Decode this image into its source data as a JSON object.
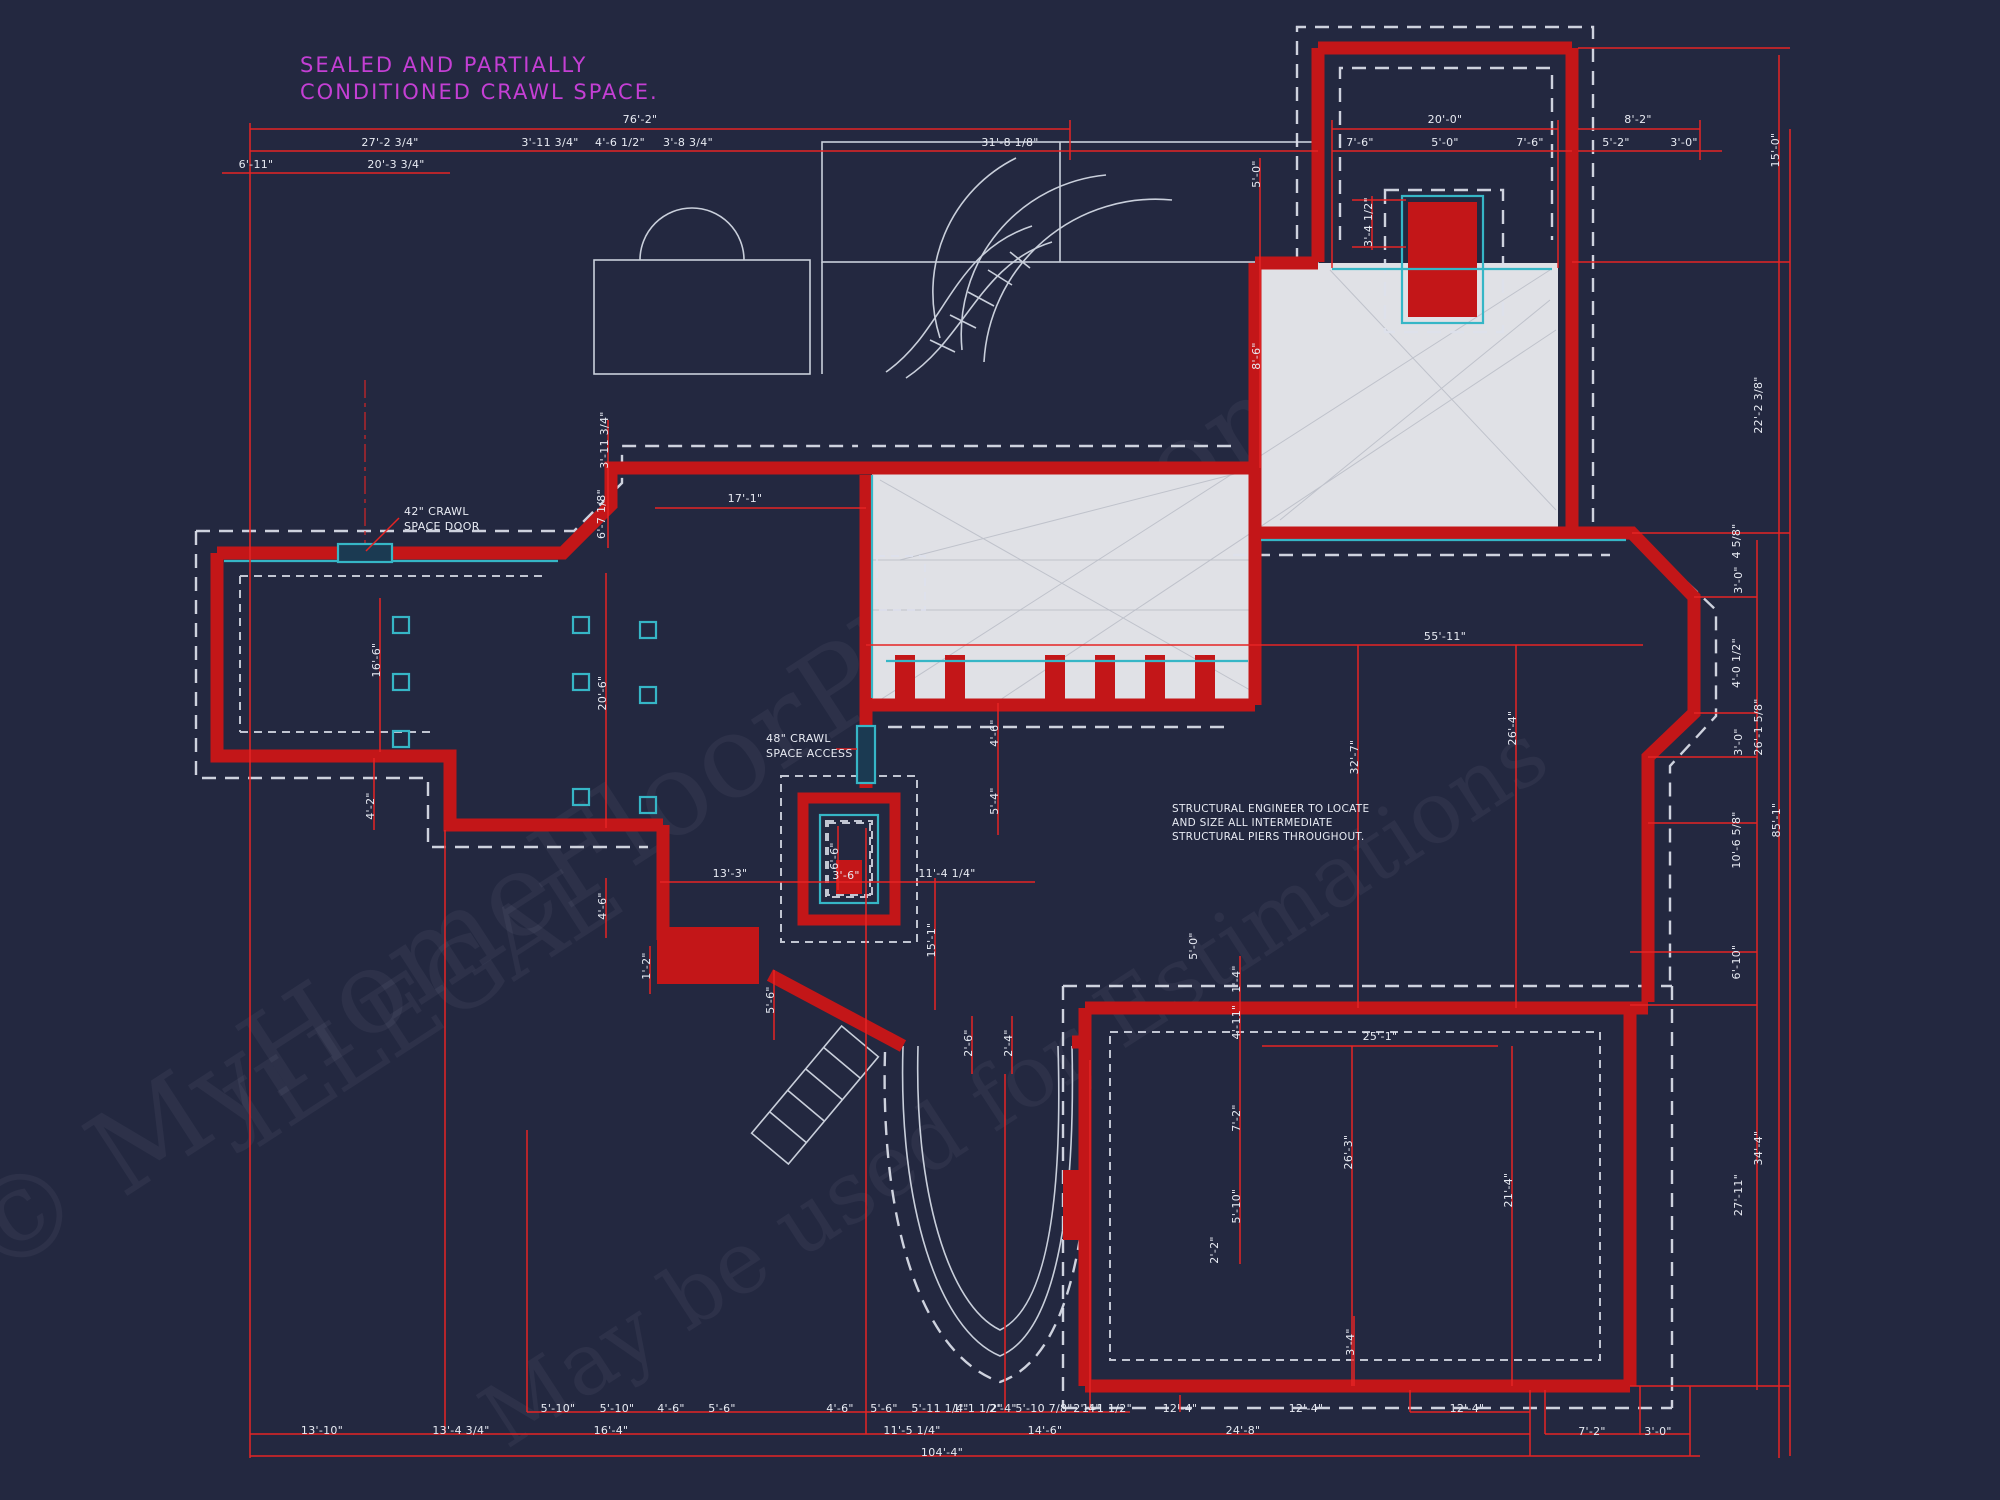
{
  "palette": {
    "background": "#232840",
    "wall_red": "#c31618",
    "dimension_red": "#e62424",
    "footing_white": "#dde1ec",
    "teal_accent": "#36b6c6",
    "slab_gray": "#e0e1e6",
    "note_magenta": "#c43fd4",
    "text_white": "#e8ebf3"
  },
  "annotations": [
    {
      "name": "crawl-space-note",
      "x": 300,
      "y": 72,
      "lh": 27,
      "size": 21,
      "spacing": "2px",
      "color": "#c43fd4",
      "lines": [
        "SEALED AND PARTIALLY",
        "CONDITIONED CRAWL SPACE."
      ]
    },
    {
      "name": "crawl-door-label",
      "x": 404,
      "y": 515,
      "lh": 15,
      "size": 11,
      "spacing": "0.4px",
      "color": "#e8ebf3",
      "lines": [
        "42\" CRAWL",
        "SPACE DOOR"
      ]
    },
    {
      "name": "crawl-access-label",
      "x": 766,
      "y": 742,
      "lh": 15,
      "size": 11,
      "spacing": "0.4px",
      "color": "#e8ebf3",
      "lines": [
        "48\" CRAWL",
        "SPACE ACCESS"
      ]
    },
    {
      "name": "engineer-note",
      "x": 1172,
      "y": 812,
      "lh": 14,
      "size": 10.5,
      "spacing": "0.3px",
      "color": "#e8ebf3",
      "lines": [
        "STRUCTURAL ENGINEER TO LOCATE",
        "AND SIZE ALL INTERMEDIATE",
        "STRUCTURAL PIERS THROUGHOUT."
      ]
    }
  ],
  "watermarks": [
    {
      "text": "© MyHomeFloorPlans.com",
      "x": 660,
      "y": 850,
      "size": 115,
      "rot": -33
    },
    {
      "text": "ILLEGAL",
      "x": 440,
      "y": 1030,
      "size": 95,
      "rot": -33
    },
    {
      "text": "May be used for Estimations",
      "x": 1030,
      "y": 1110,
      "size": 86,
      "rot": -33
    }
  ],
  "dimensions": [
    [
      "76'-2\"",
      640,
      123,
      "h"
    ],
    [
      "20'-0\"",
      1445,
      123,
      "h"
    ],
    [
      "8'-2\"",
      1638,
      123,
      "h"
    ],
    [
      "27'-2 3/4\"",
      390,
      146,
      "h"
    ],
    [
      "3'-11 3/4\"",
      550,
      146,
      "h"
    ],
    [
      "4'-6 1/2\"",
      620,
      146,
      "h"
    ],
    [
      "3'-8 3/4\"",
      688,
      146,
      "h"
    ],
    [
      "31'-8 1/8\"",
      1010,
      146,
      "h"
    ],
    [
      "7'-6\"",
      1360,
      146,
      "h"
    ],
    [
      "5'-0\"",
      1445,
      146,
      "h"
    ],
    [
      "7'-6\"",
      1530,
      146,
      "h"
    ],
    [
      "5'-2\"",
      1616,
      146,
      "h"
    ],
    [
      "3'-0\"",
      1684,
      146,
      "h"
    ],
    [
      "6'-11\"",
      256,
      168,
      "h"
    ],
    [
      "20'-3 3/4\"",
      396,
      168,
      "h"
    ],
    [
      "5'-0\"",
      1260,
      174,
      "v"
    ],
    [
      "8'-6\"",
      1260,
      356,
      "v"
    ],
    [
      "3'-4 1/2\"",
      1372,
      222,
      "v"
    ],
    [
      "15'-0\"",
      1779,
      150,
      "v"
    ],
    [
      "22'-2 3/8\"",
      1762,
      405,
      "v"
    ],
    [
      "4 5/8\"",
      1740,
      541,
      "v"
    ],
    [
      "3'-0\"",
      1742,
      580,
      "v"
    ],
    [
      "4'-0 1/2\"",
      1740,
      663,
      "v"
    ],
    [
      "3'-0\"",
      1742,
      742,
      "v"
    ],
    [
      "26'-1 5/8\"",
      1762,
      727,
      "v"
    ],
    [
      "10'-6 5/8\"",
      1740,
      840,
      "v"
    ],
    [
      "85'-1\"",
      1780,
      820,
      "v"
    ],
    [
      "6'-10\"",
      1740,
      962,
      "v"
    ],
    [
      "34'-4\"",
      1762,
      1148,
      "v"
    ],
    [
      "27'-11\"",
      1742,
      1195,
      "v"
    ],
    [
      "55'-11\"",
      1445,
      640,
      "h"
    ],
    [
      "32'-7\"",
      1358,
      757,
      "v"
    ],
    [
      "26'-4\"",
      1516,
      728,
      "v"
    ],
    [
      "17'-1\"",
      745,
      502,
      "h"
    ],
    [
      "3'-11 3/4\"",
      608,
      440,
      "v"
    ],
    [
      "6'-7 1/8\"",
      605,
      514,
      "v"
    ],
    [
      "16'-6\"",
      380,
      660,
      "v"
    ],
    [
      "20'-6\"",
      606,
      693,
      "v"
    ],
    [
      "4'-2\"",
      374,
      806,
      "v"
    ],
    [
      "4'-6\"",
      606,
      906,
      "v"
    ],
    [
      "13'-3\"",
      730,
      877,
      "h"
    ],
    [
      "3'-6\"",
      846,
      879,
      "h"
    ],
    [
      "6'-6\"",
      838,
      856,
      "v"
    ],
    [
      "11'-4 1/4\"",
      947,
      877,
      "h"
    ],
    [
      "4'-6\"",
      998,
      733,
      "v"
    ],
    [
      "5'-4\"",
      998,
      801,
      "v"
    ],
    [
      "15'-1\"",
      935,
      940,
      "v"
    ],
    [
      "5'-6\"",
      774,
      1000,
      "v"
    ],
    [
      "1'-2\"",
      650,
      966,
      "v"
    ],
    [
      "2'-6\"",
      972,
      1043,
      "v"
    ],
    [
      "2'-4\"",
      1012,
      1043,
      "v"
    ],
    [
      "5'-0\"",
      1197,
      946,
      "v"
    ],
    [
      "1'-4\"",
      1240,
      979,
      "v"
    ],
    [
      "4'-11\"",
      1240,
      1022,
      "v"
    ],
    [
      "7'-2\"",
      1240,
      1118,
      "v"
    ],
    [
      "5'-10\"",
      1240,
      1206,
      "v"
    ],
    [
      "2'-2\"",
      1218,
      1250,
      "v"
    ],
    [
      "25'-1\"",
      1380,
      1040,
      "h"
    ],
    [
      "26'-3\"",
      1352,
      1152,
      "v"
    ],
    [
      "21'-4\"",
      1512,
      1190,
      "v"
    ],
    [
      "3'-4\"",
      1354,
      1342,
      "v"
    ],
    [
      "5'-10\"",
      558,
      1412,
      "h"
    ],
    [
      "5'-10\"",
      617,
      1412,
      "h"
    ],
    [
      "4'-6\"",
      671,
      1412,
      "h"
    ],
    [
      "5'-6\"",
      722,
      1412,
      "h"
    ],
    [
      "4'-6\"",
      840,
      1412,
      "h"
    ],
    [
      "5'-6\"",
      884,
      1412,
      "h"
    ],
    [
      "5'-11 1/4\"",
      940,
      1412,
      "h"
    ],
    [
      "1'-1 1/2\"",
      978,
      1412,
      "h"
    ],
    [
      "2'-4\"",
      1003,
      1412,
      "h"
    ],
    [
      "5'-10 7/8\"",
      1044,
      1412,
      "h"
    ],
    [
      "2'-4\"",
      1087,
      1412,
      "h"
    ],
    [
      "1'-1 1/2\"",
      1107,
      1412,
      "h"
    ],
    [
      "12'-4\"",
      1180,
      1412,
      "h"
    ],
    [
      "12'-4\"",
      1306,
      1412,
      "h"
    ],
    [
      "12'-4\"",
      1467,
      1412,
      "h"
    ],
    [
      "13'-10\"",
      322,
      1434,
      "h"
    ],
    [
      "13'-4 3/4\"",
      461,
      1434,
      "h"
    ],
    [
      "16'-4\"",
      611,
      1434,
      "h"
    ],
    [
      "11'-5 1/4\"",
      912,
      1434,
      "h"
    ],
    [
      "14'-6\"",
      1045,
      1434,
      "h"
    ],
    [
      "24'-8\"",
      1243,
      1434,
      "h"
    ],
    [
      "7'-2\"",
      1592,
      1435,
      "h"
    ],
    [
      "3'-0\"",
      1658,
      1435,
      "h"
    ],
    [
      "104'-4\"",
      942,
      1456,
      "h"
    ]
  ]
}
